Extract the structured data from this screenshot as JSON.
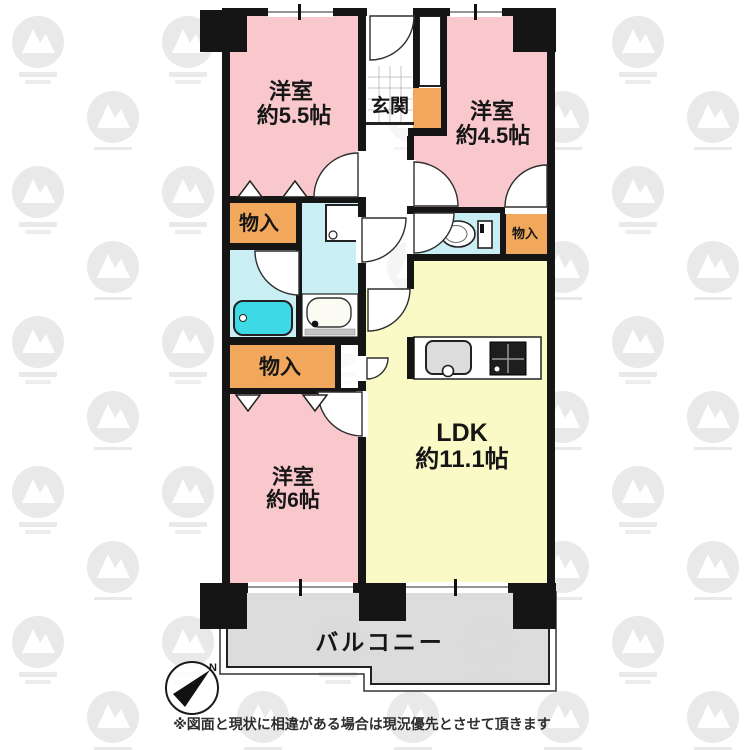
{
  "plan": {
    "rooms": {
      "bedroom_55": {
        "name": "洋室",
        "size": "約5.5帖"
      },
      "bedroom_45": {
        "name": "洋室",
        "size": "約4.5帖"
      },
      "bedroom_6": {
        "name": "洋室",
        "size": "約6帖"
      },
      "ldk": {
        "name": "LDK",
        "size": "約11.1帖"
      },
      "entrance": {
        "name": "玄関"
      },
      "balcony": {
        "name": "バルコニー"
      },
      "closet_top_left": {
        "name": "物入"
      },
      "closet_bottom_left": {
        "name": "物入"
      },
      "closet_right": {
        "name": "物入"
      }
    },
    "fixtures": [
      "bathtub",
      "washbasin",
      "washing-machine-pan",
      "toilet",
      "kitchen-sink",
      "stove",
      "shoe-cabinet",
      "entrance-door"
    ],
    "compass": {
      "north_label": "N"
    },
    "footnote": "※図面と現状に相違がある場合は現況優先とさせて頂きます",
    "colors": {
      "bedroom": "#f9c8cc",
      "ldk": "#fafac6",
      "closet": "#f2a85c",
      "wet_area": "#c9eef4",
      "bathtub": "#3ed9e6",
      "balcony": "#d9d9d9",
      "wall": "#151515",
      "background": "#ffffff",
      "watermark": "#e9e9e9"
    }
  }
}
